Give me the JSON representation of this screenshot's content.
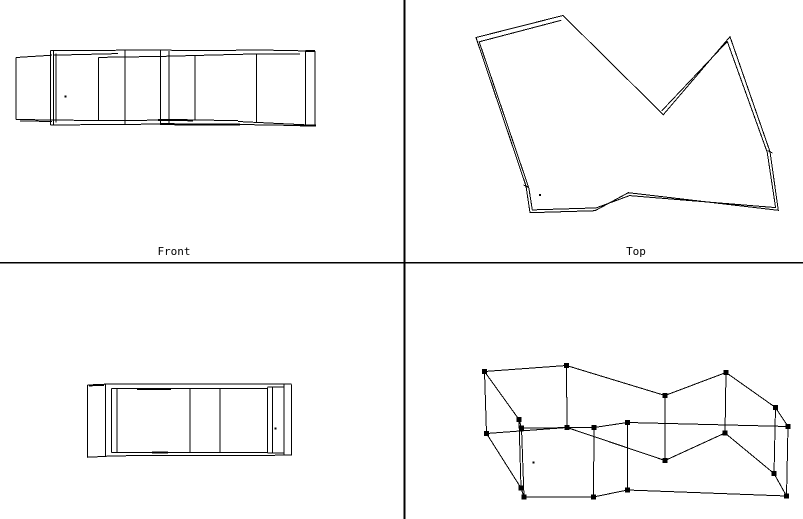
{
  "colors": {
    "background": "#ffffff",
    "line": "#000000"
  },
  "splitters": {
    "vertical_x": 403.5,
    "horizontal_y": 261.8,
    "thickness": 1.8
  },
  "viewports": {
    "front": {
      "label": "Front",
      "verticals": [
        [
          16,
          57.5,
          119.5
        ],
        [
          50.5,
          50.5,
          125
        ],
        [
          53.5,
          50.5,
          125
        ],
        [
          56,
          53.5,
          122.5
        ],
        [
          98.5,
          57.4,
          121
        ],
        [
          125,
          50.2,
          123.8
        ],
        [
          160.5,
          50.2,
          123.8
        ],
        [
          169,
          51,
          124
        ],
        [
          195,
          55.3,
          120.5
        ],
        [
          256.5,
          53.3,
          122
        ],
        [
          305.5,
          51,
          125.3
        ],
        [
          315,
          50.8,
          125.5
        ]
      ],
      "segments": [
        [
          16,
          57.5,
          52,
          55.2,
          1
        ],
        [
          50.5,
          50.5,
          157,
          50.1,
          1
        ],
        [
          157,
          50.1,
          212,
          50.7,
          1
        ],
        [
          210,
          50.7,
          256.5,
          49.9,
          1
        ],
        [
          256.5,
          49.9,
          305.5,
          50.9,
          1
        ],
        [
          305.5,
          50.9,
          315,
          50.8,
          2
        ],
        [
          53.5,
          55.2,
          118,
          53.6,
          1
        ],
        [
          98.5,
          57.4,
          161,
          56.4,
          1
        ],
        [
          161,
          56.4,
          210,
          55.1,
          1
        ],
        [
          210,
          55.1,
          256.5,
          53.9,
          1
        ],
        [
          256.5,
          53.9,
          300,
          54,
          1
        ],
        [
          16,
          119.5,
          100,
          120.6,
          1
        ],
        [
          100,
          120.6,
          195,
          119.9,
          1
        ],
        [
          158,
          120,
          193,
          120.3,
          2
        ],
        [
          195,
          119.9,
          238,
          120.7,
          1
        ],
        [
          238,
          121.5,
          315,
          125.3,
          1
        ],
        [
          50.5,
          125,
          160,
          124.1,
          1
        ],
        [
          160,
          124.2,
          240,
          124.5,
          2
        ],
        [
          240,
          124.5,
          315,
          125.8,
          1
        ],
        [
          300,
          125.3,
          316,
          125.4,
          2
        ],
        [
          20,
          120.9,
          52,
          121.5,
          1
        ]
      ],
      "pivot_dot": [
        65.3,
        96.7
      ]
    },
    "top": {
      "label": "Top",
      "outer_polygon": [
        [
          476,
          37.5
        ],
        [
          563,
          15.5
        ],
        [
          663.3,
          114.7
        ],
        [
          730,
          36.7
        ],
        [
          770,
          151.7
        ],
        [
          778.3,
          210.3
        ],
        [
          628.3,
          192.7
        ],
        [
          595,
          210.7
        ],
        [
          530,
          212.7
        ],
        [
          526,
          186
        ]
      ],
      "inner_polyline": [
        [
          661.8,
          110.8
        ],
        [
          727.3,
          41.5
        ],
        [
          767.2,
          152.2
        ],
        [
          775.6,
          207.6
        ],
        [
          629.5,
          195.6
        ],
        [
          596.2,
          207.9
        ],
        [
          532.3,
          209.9
        ],
        [
          528.9,
          188.3
        ],
        [
          479.2,
          41.8
        ],
        [
          561.2,
          20.3
        ]
      ],
      "wall_ticks": [
        [
          523.5,
          185,
          529,
          187.5
        ],
        [
          767.5,
          150.5,
          772.5,
          153
        ]
      ],
      "pivot_dot": [
        540,
        195
      ]
    },
    "side": {
      "verticals": [
        [
          87.3,
          385,
          457.3
        ],
        [
          105.5,
          384.2,
          456.2
        ],
        [
          111.7,
          388.3,
          452.3
        ],
        [
          117,
          388.3,
          452.3
        ],
        [
          190,
          388.3,
          452.3
        ],
        [
          220,
          388.3,
          452.3
        ],
        [
          267.3,
          387.3,
          452.7
        ],
        [
          272.7,
          386.9,
          453.1
        ],
        [
          284,
          384.6,
          455.4
        ],
        [
          291.7,
          384.3,
          455.7
        ]
      ],
      "segments": [
        [
          87.3,
          385,
          105.5,
          384.2,
          1
        ],
        [
          105.5,
          383.8,
          291.7,
          384,
          1
        ],
        [
          89,
          385.9,
          104,
          385.3,
          1
        ],
        [
          111.7,
          388.3,
          267.3,
          388.3,
          1
        ],
        [
          137,
          389.2,
          171,
          389.2,
          2
        ],
        [
          267.3,
          387.2,
          284,
          386.9,
          1
        ],
        [
          87.3,
          457.3,
          113,
          455.9,
          1
        ],
        [
          113,
          455.8,
          291.7,
          455.2,
          1
        ],
        [
          111.7,
          452.3,
          267.3,
          452.3,
          1
        ],
        [
          152,
          452.6,
          168,
          452.6,
          2
        ],
        [
          267.3,
          452.8,
          284,
          453.1,
          1
        ]
      ],
      "pivot_dot": [
        275.3,
        428.3
      ]
    },
    "perspective": {
      "top_ring": [
        [
          484.5,
          371.5
        ],
        [
          566.5,
          365.5
        ],
        [
          665,
          395.5
        ],
        [
          726,
          372.5
        ],
        [
          775.5,
          407.5
        ],
        [
          788,
          426.5
        ],
        [
          627.5,
          422.5
        ],
        [
          594,
          427.5
        ],
        [
          521.5,
          428
        ],
        [
          519,
          419.5
        ]
      ],
      "bottom_ring": [
        [
          486.5,
          433.5
        ],
        [
          567,
          427.5
        ],
        [
          665,
          460.5
        ],
        [
          725,
          433
        ],
        [
          774,
          473.5
        ],
        [
          786.5,
          496
        ],
        [
          627.5,
          490
        ],
        [
          593.5,
          497
        ],
        [
          524,
          497
        ],
        [
          521,
          488
        ]
      ],
      "handle_size": 5,
      "pivot_dot": [
        533.5,
        462.3
      ]
    }
  }
}
